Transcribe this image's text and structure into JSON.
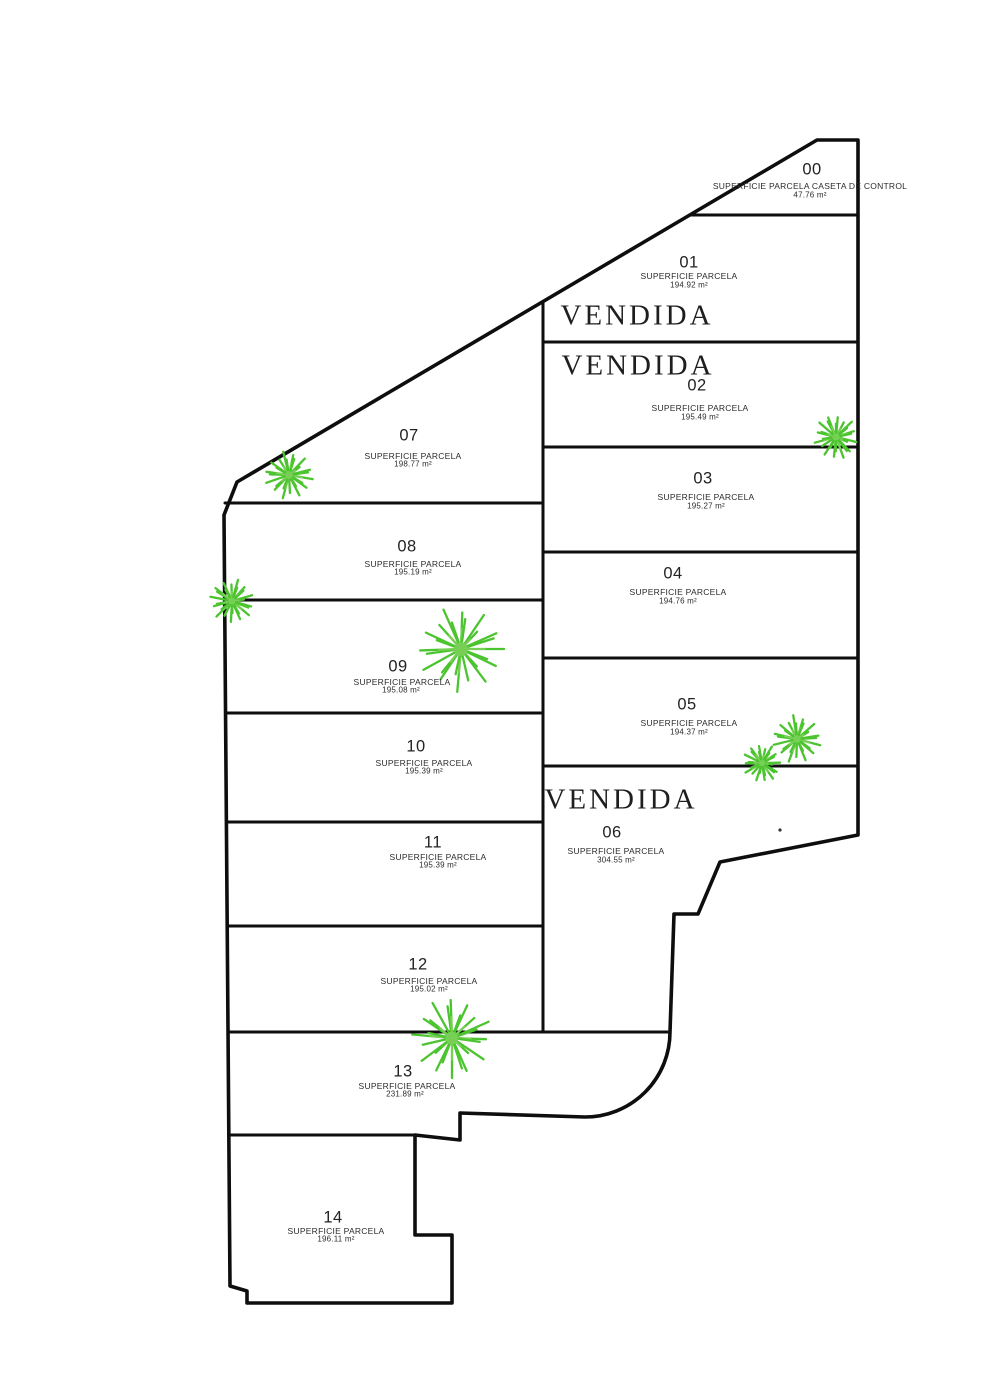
{
  "plan": {
    "type": "parcel-subdivision-plan",
    "colors": {
      "outline": "#0e0e0e",
      "plant_green": "#4cc42f",
      "plant_green_light": "#77d055",
      "text": "#232323"
    }
  },
  "sold_labels": [
    {
      "text": "VENDIDA",
      "x": 637,
      "y": 316
    },
    {
      "text": "VENDIDA",
      "x": 638,
      "y": 366
    },
    {
      "text": "VENDIDA",
      "x": 621,
      "y": 800
    }
  ],
  "parcels": [
    {
      "id": "00",
      "num": "00",
      "label": "SUPERFICIE PARCELA CASETA DE CONTROL",
      "area": "47.76 m²",
      "num_pos": [
        812,
        170
      ],
      "label_pos": [
        810,
        186
      ],
      "area_pos": [
        810,
        195
      ]
    },
    {
      "id": "01",
      "num": "01",
      "label": "SUPERFICIE PARCELA",
      "area": "194.92 m²",
      "num_pos": [
        689,
        263
      ],
      "label_pos": [
        689,
        276
      ],
      "area_pos": [
        689,
        285
      ]
    },
    {
      "id": "02",
      "num": "02",
      "label": "SUPERFICIE PARCELA",
      "area": "195.49 m²",
      "num_pos": [
        697,
        386
      ],
      "label_pos": [
        700,
        408
      ],
      "area_pos": [
        700,
        417
      ]
    },
    {
      "id": "03",
      "num": "03",
      "label": "SUPERFICIE PARCELA",
      "area": "195.27 m²",
      "num_pos": [
        703,
        479
      ],
      "label_pos": [
        706,
        497
      ],
      "area_pos": [
        706,
        506
      ]
    },
    {
      "id": "04",
      "num": "04",
      "label": "SUPERFICIE PARCELA",
      "area": "194.76 m²",
      "num_pos": [
        673,
        574
      ],
      "label_pos": [
        678,
        592
      ],
      "area_pos": [
        678,
        601
      ]
    },
    {
      "id": "05",
      "num": "05",
      "label": "SUPERFICIE PARCELA",
      "area": "194.37 m²",
      "num_pos": [
        687,
        705
      ],
      "label_pos": [
        689,
        723
      ],
      "area_pos": [
        689,
        732
      ]
    },
    {
      "id": "06",
      "num": "06",
      "label": "SUPERFICIE PARCELA",
      "area": "304.55 m²",
      "num_pos": [
        612,
        833
      ],
      "label_pos": [
        616,
        851
      ],
      "area_pos": [
        616,
        860
      ]
    },
    {
      "id": "07",
      "num": "07",
      "label": "SUPERFICIE PARCELA",
      "area": "198.77 m²",
      "num_pos": [
        409,
        436
      ],
      "label_pos": [
        413,
        456
      ],
      "area_pos": [
        413,
        464
      ]
    },
    {
      "id": "08",
      "num": "08",
      "label": "SUPERFICIE PARCELA",
      "area": "195.19 m²",
      "num_pos": [
        407,
        547
      ],
      "label_pos": [
        413,
        564
      ],
      "area_pos": [
        413,
        572
      ]
    },
    {
      "id": "09",
      "num": "09",
      "label": "SUPERFICIE PARCELA",
      "area": "195.08 m²",
      "num_pos": [
        398,
        667
      ],
      "label_pos": [
        402,
        682
      ],
      "area_pos": [
        401,
        690
      ]
    },
    {
      "id": "10",
      "num": "10",
      "label": "SUPERFICIE PARCELA",
      "area": "195.39 m²",
      "num_pos": [
        416,
        747
      ],
      "label_pos": [
        424,
        763
      ],
      "area_pos": [
        424,
        771
      ]
    },
    {
      "id": "11",
      "num": "11",
      "label": "SUPERFICIE PARCELA",
      "area": "195.39 m²",
      "num_pos": [
        433,
        843
      ],
      "label_pos": [
        438,
        857
      ],
      "area_pos": [
        438,
        865
      ]
    },
    {
      "id": "12",
      "num": "12",
      "label": "SUPERFICIE PARCELA",
      "area": "195.02 m²",
      "num_pos": [
        418,
        965
      ],
      "label_pos": [
        429,
        981
      ],
      "area_pos": [
        429,
        989
      ]
    },
    {
      "id": "13",
      "num": "13",
      "label": "SUPERFICIE PARCELA",
      "area": "231.89 m²",
      "num_pos": [
        403,
        1072
      ],
      "label_pos": [
        407,
        1086
      ],
      "area_pos": [
        405,
        1094
      ]
    },
    {
      "id": "14",
      "num": "14",
      "label": "SUPERFICIE PARCELA",
      "area": "196.11 m²",
      "num_pos": [
        333,
        1218
      ],
      "label_pos": [
        336,
        1231
      ],
      "area_pos": [
        336,
        1239
      ]
    }
  ],
  "plants": [
    {
      "x": 289,
      "y": 475,
      "r": 24,
      "rot": 10
    },
    {
      "x": 232,
      "y": 601,
      "r": 22,
      "rot": 40
    },
    {
      "x": 461,
      "y": 649,
      "r": 43,
      "rot": 0
    },
    {
      "x": 836,
      "y": 437,
      "r": 22,
      "rot": 70
    },
    {
      "x": 797,
      "y": 739,
      "r": 24,
      "rot": 15
    },
    {
      "x": 762,
      "y": 763,
      "r": 19,
      "rot": 55
    },
    {
      "x": 452,
      "y": 1038,
      "r": 40,
      "rot": 90
    }
  ]
}
